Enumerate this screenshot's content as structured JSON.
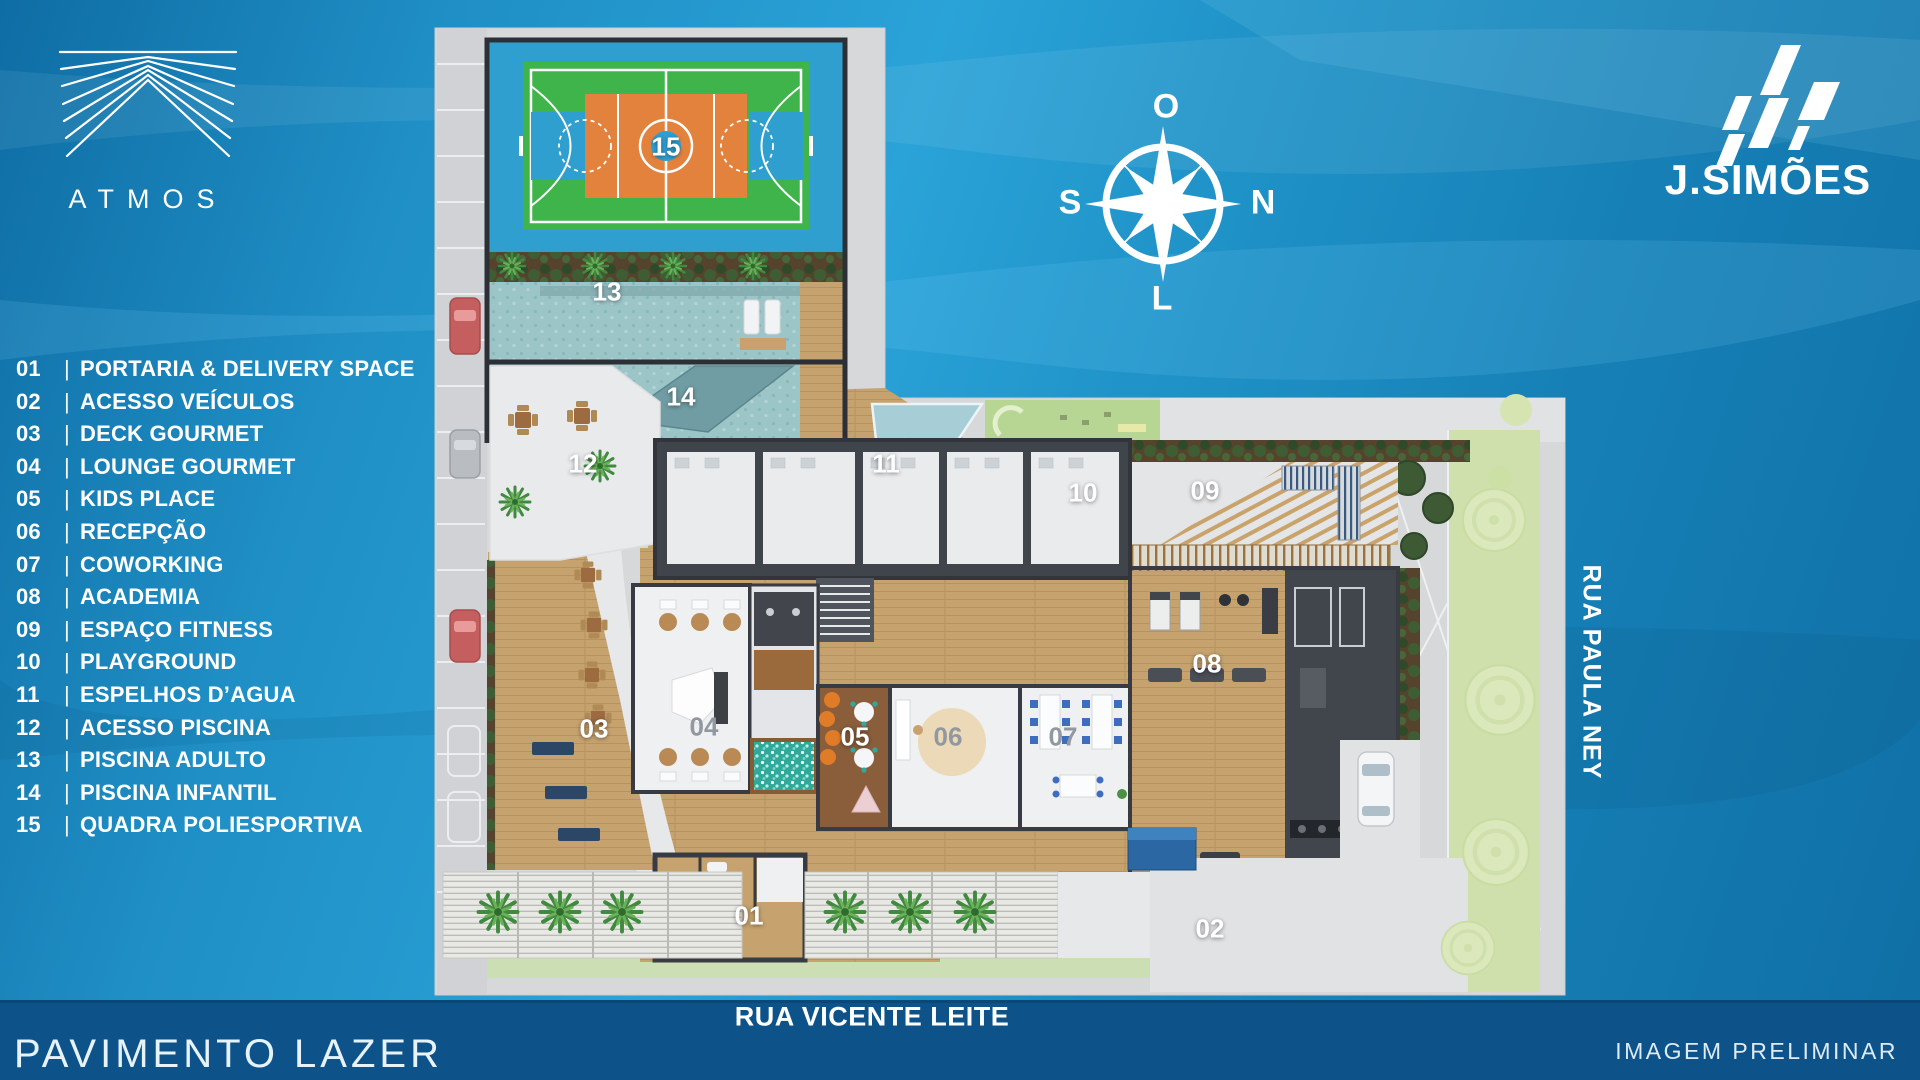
{
  "branding": {
    "atmos": "ATMOS",
    "jsimoes": "J.SIMÕES"
  },
  "compass": {
    "top": "O",
    "right": "N",
    "left": "S",
    "bottom": "L"
  },
  "legend": {
    "separator": "|",
    "items": [
      {
        "num": "01",
        "label": "PORTARIA & DELIVERY SPACE"
      },
      {
        "num": "02",
        "label": "ACESSO VEÍCULOS"
      },
      {
        "num": "03",
        "label": "DECK GOURMET"
      },
      {
        "num": "04",
        "label": "LOUNGE GOURMET"
      },
      {
        "num": "05",
        "label": "KIDS PLACE"
      },
      {
        "num": "06",
        "label": "RECEPÇÃO"
      },
      {
        "num": "07",
        "label": "COWORKING"
      },
      {
        "num": "08",
        "label": "ACADEMIA"
      },
      {
        "num": "09",
        "label": "ESPAÇO FITNESS"
      },
      {
        "num": "10",
        "label": "PLAYGROUND"
      },
      {
        "num": "11",
        "label": "ESPELHOS D’AGUA"
      },
      {
        "num": "12",
        "label": "ACESSO PISCINA"
      },
      {
        "num": "13",
        "label": "PISCINA ADULTO"
      },
      {
        "num": "14",
        "label": "PISCINA INFANTIL"
      },
      {
        "num": "15",
        "label": "QUADRA POLIESPORTIVA"
      }
    ]
  },
  "plan": {
    "labels": {
      "n01": "01",
      "n02": "02",
      "n03": "03",
      "n04": "04",
      "n05": "05",
      "n06": "06",
      "n07": "07",
      "n08": "08",
      "n09": "09",
      "n10": "10",
      "n11": "11",
      "n12": "12",
      "n13": "13",
      "n14": "14",
      "n15": "15"
    },
    "streets": {
      "bottom": "RUA VICENTE LEITE",
      "right": "RUA PAULA NEY"
    }
  },
  "footer": {
    "floor_title": "PAVIMENTO LAZER",
    "disclaimer": "IMAGEM PRELIMINAR"
  },
  "colors": {
    "background_top": "#2aa3d8",
    "background_deep": "#0e6da4",
    "street_band": "#0d538a",
    "court_blue": "#2f9fd0",
    "court_green": "#3eb44a",
    "court_orange": "#e2823d",
    "pool": "#9cc5c8",
    "wood_deck": "#c6a26f",
    "sidewalk": "#d6d8da",
    "text_white": "#ffffff"
  }
}
